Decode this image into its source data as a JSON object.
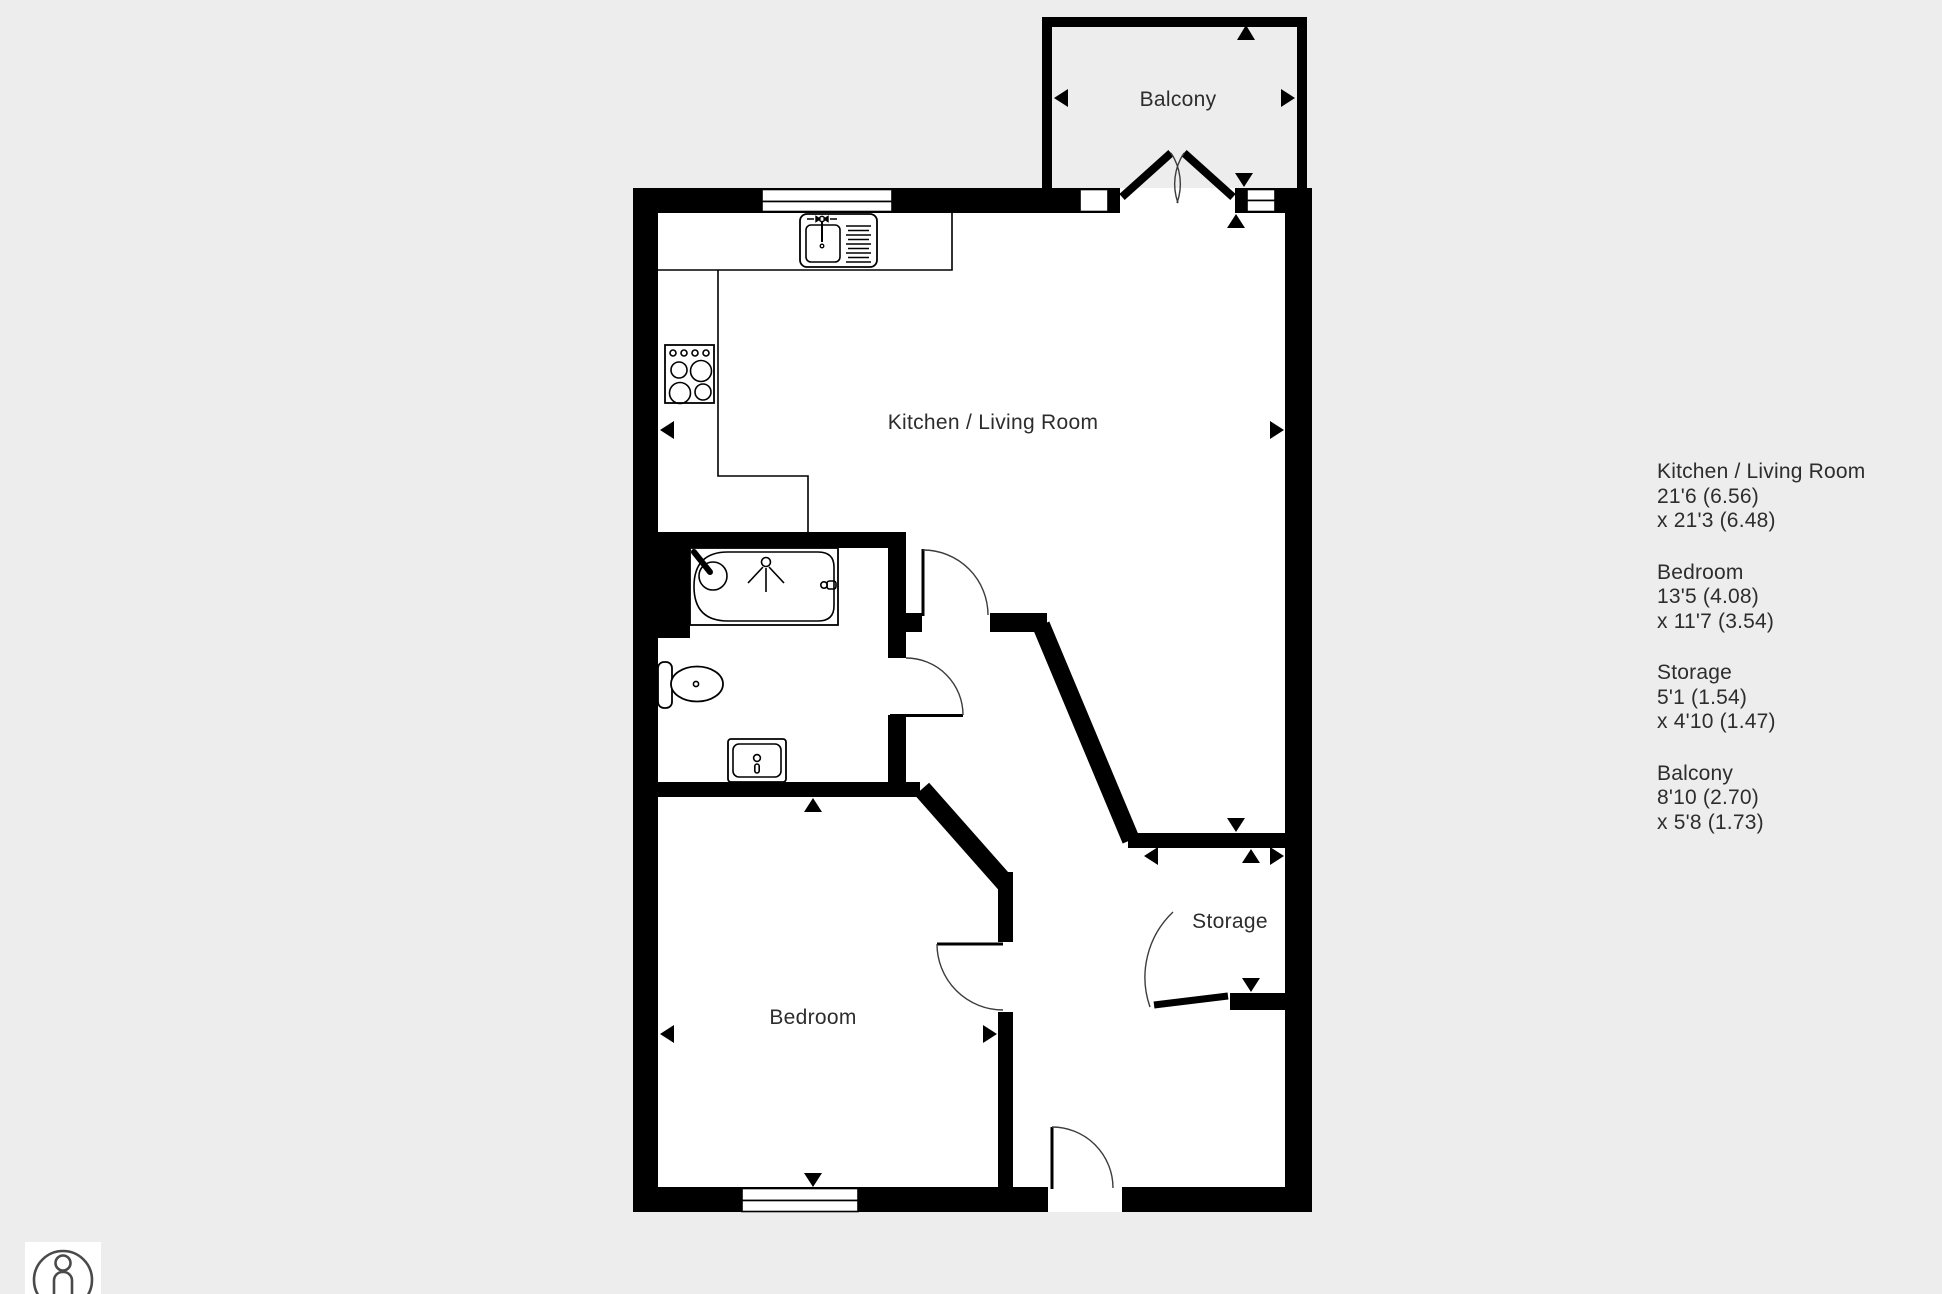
{
  "colors": {
    "background": "#ededed",
    "wall": "#000000",
    "interior": "#ffffff",
    "text": "#2d2d2d",
    "icon_stroke": "#4a4a4a"
  },
  "floor_plan": {
    "rooms": {
      "kitchen_living": "Kitchen / Living Room",
      "bedroom": "Bedroom",
      "storage": "Storage",
      "balcony": "Balcony"
    },
    "icons": [
      "kitchen-sink-icon",
      "stove-icon",
      "bath-icon",
      "toilet-icon",
      "basin-icon",
      "dimension-arrow-icon",
      "door-swing-arc"
    ]
  },
  "legend": {
    "items": [
      {
        "name": "Kitchen / Living Room",
        "dim1": "21'6 (6.56)",
        "dim2": "x 21'3 (6.48)"
      },
      {
        "name": "Bedroom",
        "dim1": "13'5 (4.08)",
        "dim2": "x 11'7 (3.54)"
      },
      {
        "name": "Storage",
        "dim1": "5'1 (1.54)",
        "dim2": "x 4'10 (1.47)"
      },
      {
        "name": "Balcony",
        "dim1": "8'10 (2.70)",
        "dim2": "x 5'8 (1.73)"
      }
    ]
  },
  "viewer": {
    "person_icon": "person-silhouette-in-circle"
  }
}
